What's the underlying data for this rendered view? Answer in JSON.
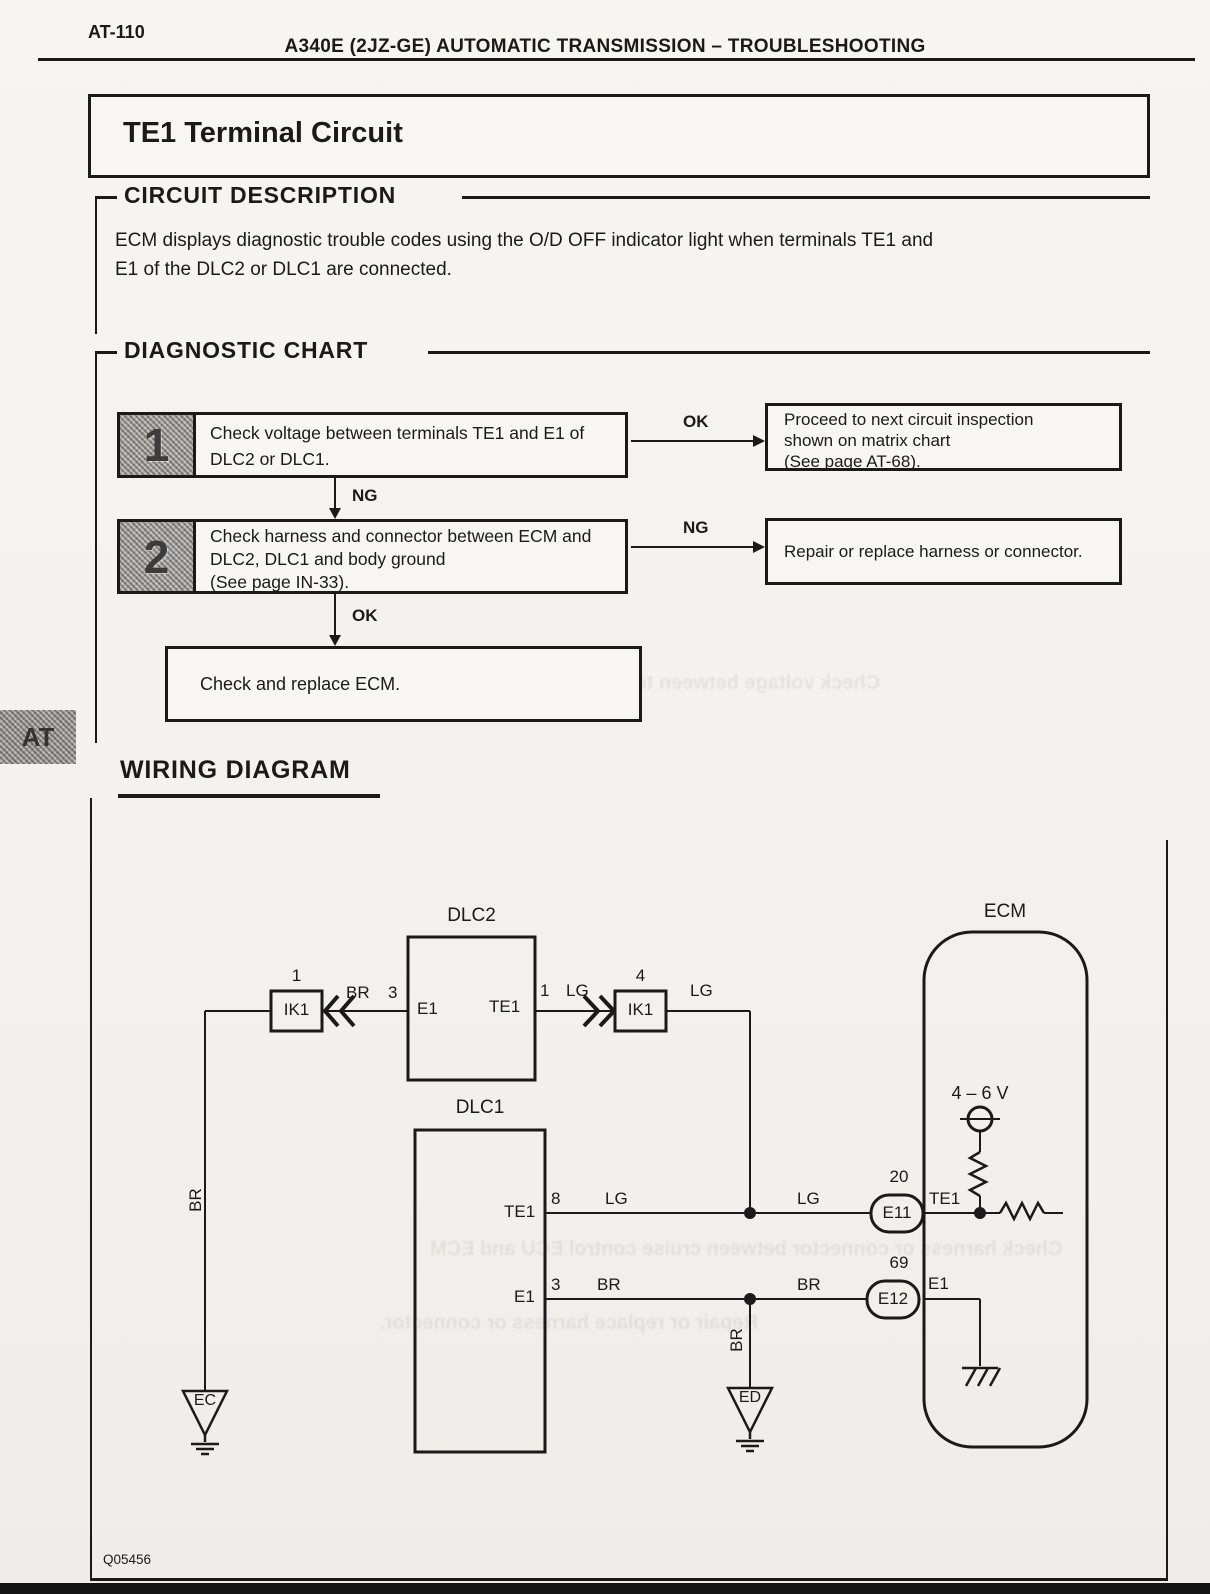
{
  "page": {
    "code": "AT-110",
    "header_title": "A340E (2JZ-GE) AUTOMATIC TRANSMISSION – TROUBLESHOOTING",
    "title": "TE1 Terminal Circuit",
    "footer_code": "Q05456",
    "side_tab": "AT"
  },
  "circuit_description": {
    "heading": "CIRCUIT DESCRIPTION",
    "body": "ECM displays diagnostic trouble codes using the O/D OFF indicator light when terminals TE1 and\nE1 of the DLC2 or DLC1 are connected."
  },
  "diagnostic_chart": {
    "heading": "DIAGNOSTIC CHART",
    "step1": {
      "number": "1",
      "text": "Check voltage between terminals TE1 and E1 of\nDLC2 or DLC1.",
      "branch_label": "OK",
      "branch_text": "Proceed to next circuit inspection\nshown on matrix chart\n(See page AT-68).",
      "down_label": "NG"
    },
    "step2": {
      "number": "2",
      "text": "Check harness and connector between ECM and\nDLC2, DLC1 and body ground\n(See page IN-33).",
      "branch_label": "NG",
      "branch_text": "Repair or replace harness or connector.",
      "down_label": "OK"
    },
    "final_text": "Check and replace ECM."
  },
  "wiring_diagram": {
    "heading": "WIRING DIAGRAM",
    "components": {
      "dlc2": "DLC2",
      "dlc1": "DLC1",
      "ecm": "ECM",
      "ik1_left": "IK1",
      "ik1_right": "IK1",
      "e11": "E11",
      "e12": "E12",
      "ec_ground": "EC",
      "ed_ground": "ED"
    },
    "pins": {
      "ik1_left_pin": "1",
      "ik1_right_pin": "4",
      "dlc2_e1_pin": "3",
      "dlc2_te1_pin": "1",
      "dlc1_te1_pin": "8",
      "dlc1_e1_pin": "3",
      "e11_pin": "20",
      "e12_pin": "69"
    },
    "terminals": {
      "dlc2_e1": "E1",
      "dlc2_te1": "TE1",
      "dlc1_te1": "TE1",
      "dlc1_e1": "E1",
      "ecm_te1": "TE1",
      "ecm_e1": "E1"
    },
    "wire_colors": {
      "br_left": "BR",
      "lg_dlc2": "LG",
      "lg_after_ik1": "LG",
      "lg_dlc1": "LG",
      "lg_to_ecm": "LG",
      "br_dlc1": "BR",
      "br_to_ecm": "BR",
      "br_left_vertical": "BR",
      "br_ed_vertical": "BR"
    },
    "voltage_label": "4 – 6 V"
  },
  "ghosts": {
    "line1": "Check voltage between terminal OD at cruise control ECU and",
    "line2": "Check harness or connector between cruise control ECU and ECM",
    "line3": "Repair or replace harness or connector."
  }
}
